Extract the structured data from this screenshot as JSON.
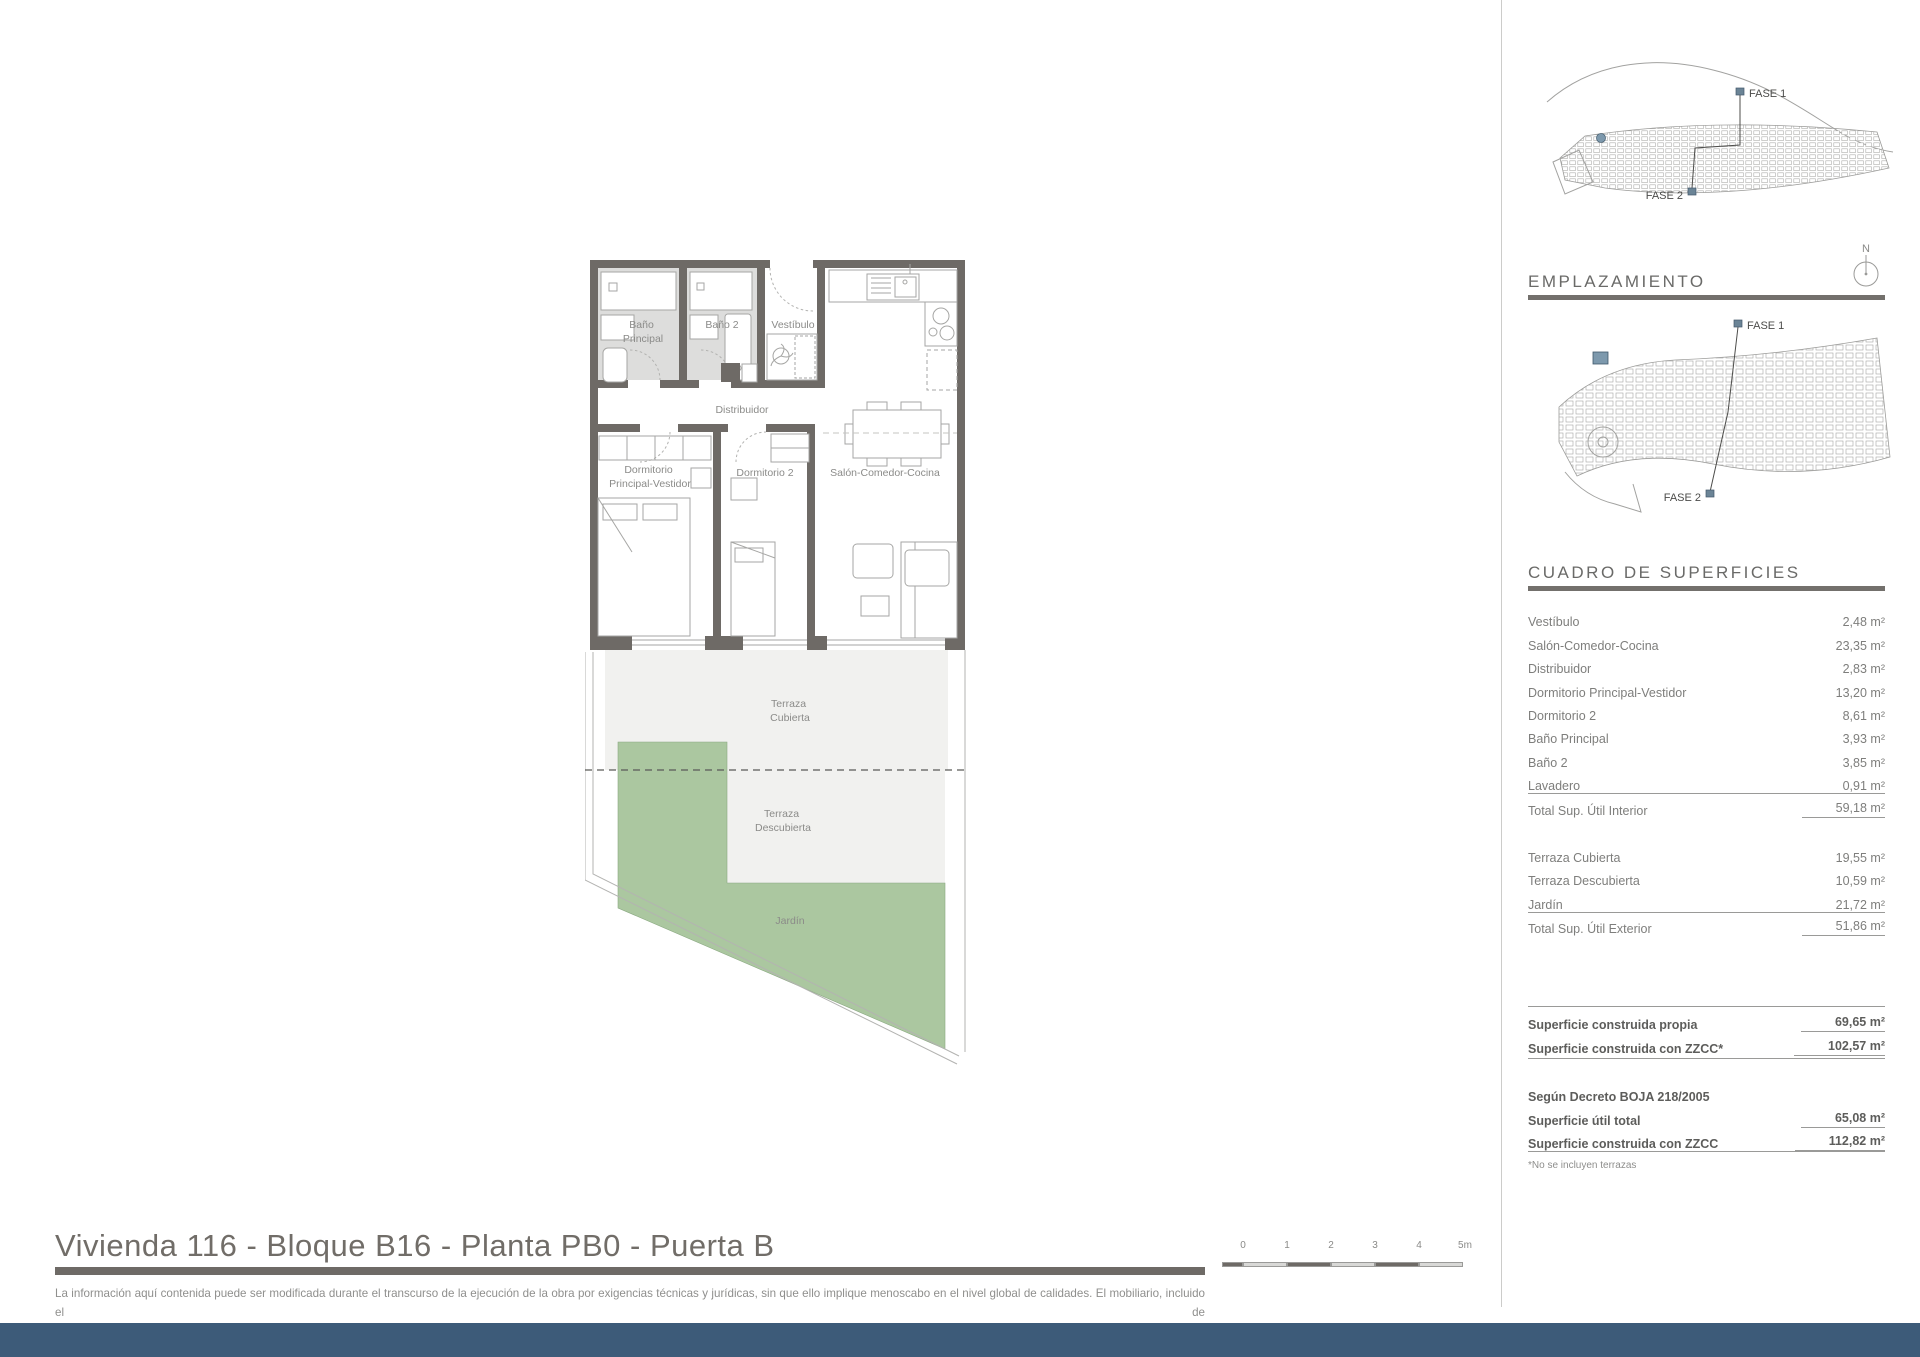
{
  "title": "Vivienda 116 - Bloque B16 - Planta PB0 - Puerta B",
  "disclaimer": {
    "line1": "La información aquí contenida puede ser modificada durante el transcurso de la ejecución de la obra por exigencias técnicas y jurídicas, sin que ello implique menoscabo en el nivel global de calidades. El mobiliario, incluido el de",
    "line2": "cocina, se refleja a efectos meramente decorativos, sin que se incluya en la oferta. Los peldaños de acceso a la vivienda y salidas a patios, puede alterarse en función de la rasante de las calles y corresponde a la D.F. fijar el criterio."
  },
  "colors": {
    "footer_blue": "#3d5b79",
    "marker_blue": "#7d99ad",
    "garden_green": "#abc7a0",
    "wall_gray": "#6e6a66",
    "bath_floor": "#dddddc",
    "terrace_gray": "#f1f1ef"
  },
  "site_overview": {
    "fase1": "FASE 1",
    "fase2": "FASE 2"
  },
  "emplazamiento": {
    "heading": "EMPLAZAMIENTO",
    "fase1": "FASE 1",
    "fase2": "FASE 2",
    "compass_n": "N"
  },
  "floor_plan": {
    "rooms": {
      "bano_principal": [
        "Baño",
        "Principal"
      ],
      "bano2": "Baño 2",
      "vestibulo": "Vestíbulo",
      "distribuidor": "Distribuidor",
      "dorm_ppal": [
        "Dormitorio",
        "Principal-Vestidor"
      ],
      "dorm2": "Dormitorio 2",
      "salon": "Salón-Comedor-Cocina",
      "terraza_cubierta": [
        "Terraza",
        "Cubierta"
      ],
      "terraza_descubierta": [
        "Terraza",
        "Descubierta"
      ],
      "jardin": "Jardín"
    }
  },
  "surfaces": {
    "heading": "CUADRO DE SUPERFICIES",
    "interior": {
      "rows": [
        {
          "label": "Vestíbulo",
          "value": "2,48 m²"
        },
        {
          "label": "Salón-Comedor-Cocina",
          "value": "23,35 m²"
        },
        {
          "label": "Distribuidor",
          "value": "2,83 m²"
        },
        {
          "label": "Dormitorio Principal-Vestidor",
          "value": "13,20 m²"
        },
        {
          "label": "Dormitorio 2",
          "value": "8,61 m²"
        },
        {
          "label": "Baño Principal",
          "value": "3,93 m²"
        },
        {
          "label": "Baño 2",
          "value": "3,85 m²"
        },
        {
          "label": "Lavadero",
          "value": "0,91 m²"
        }
      ],
      "total": {
        "label": "Total Sup. Útil Interior",
        "value": "59,18 m²"
      }
    },
    "exterior": {
      "rows": [
        {
          "label": "Terraza Cubierta",
          "value": "19,55 m²"
        },
        {
          "label": "Terraza Descubierta",
          "value": "10,59 m²"
        },
        {
          "label": "Jardín",
          "value": "21,72 m²"
        }
      ],
      "total": {
        "label": "Total Sup. Útil Exterior",
        "value": "51,86 m²"
      }
    },
    "construida": {
      "rows": [
        {
          "label": "Superficie construida propia",
          "value": "69,65 m²"
        },
        {
          "label": "Superficie construida con ZZCC*",
          "value": "102,57 m²"
        }
      ]
    },
    "decreto": {
      "heading": "Según Decreto BOJA 218/2005",
      "rows": [
        {
          "label": "Superficie útil total",
          "value": "65,08 m²"
        },
        {
          "label": "Superficie construida con ZZCC",
          "value": "112,82 m²"
        }
      ]
    },
    "footnote": "*No se incluyen terrazas"
  },
  "scale_bar": {
    "labels": [
      "0",
      "1",
      "2",
      "3",
      "4",
      "5m"
    ]
  }
}
